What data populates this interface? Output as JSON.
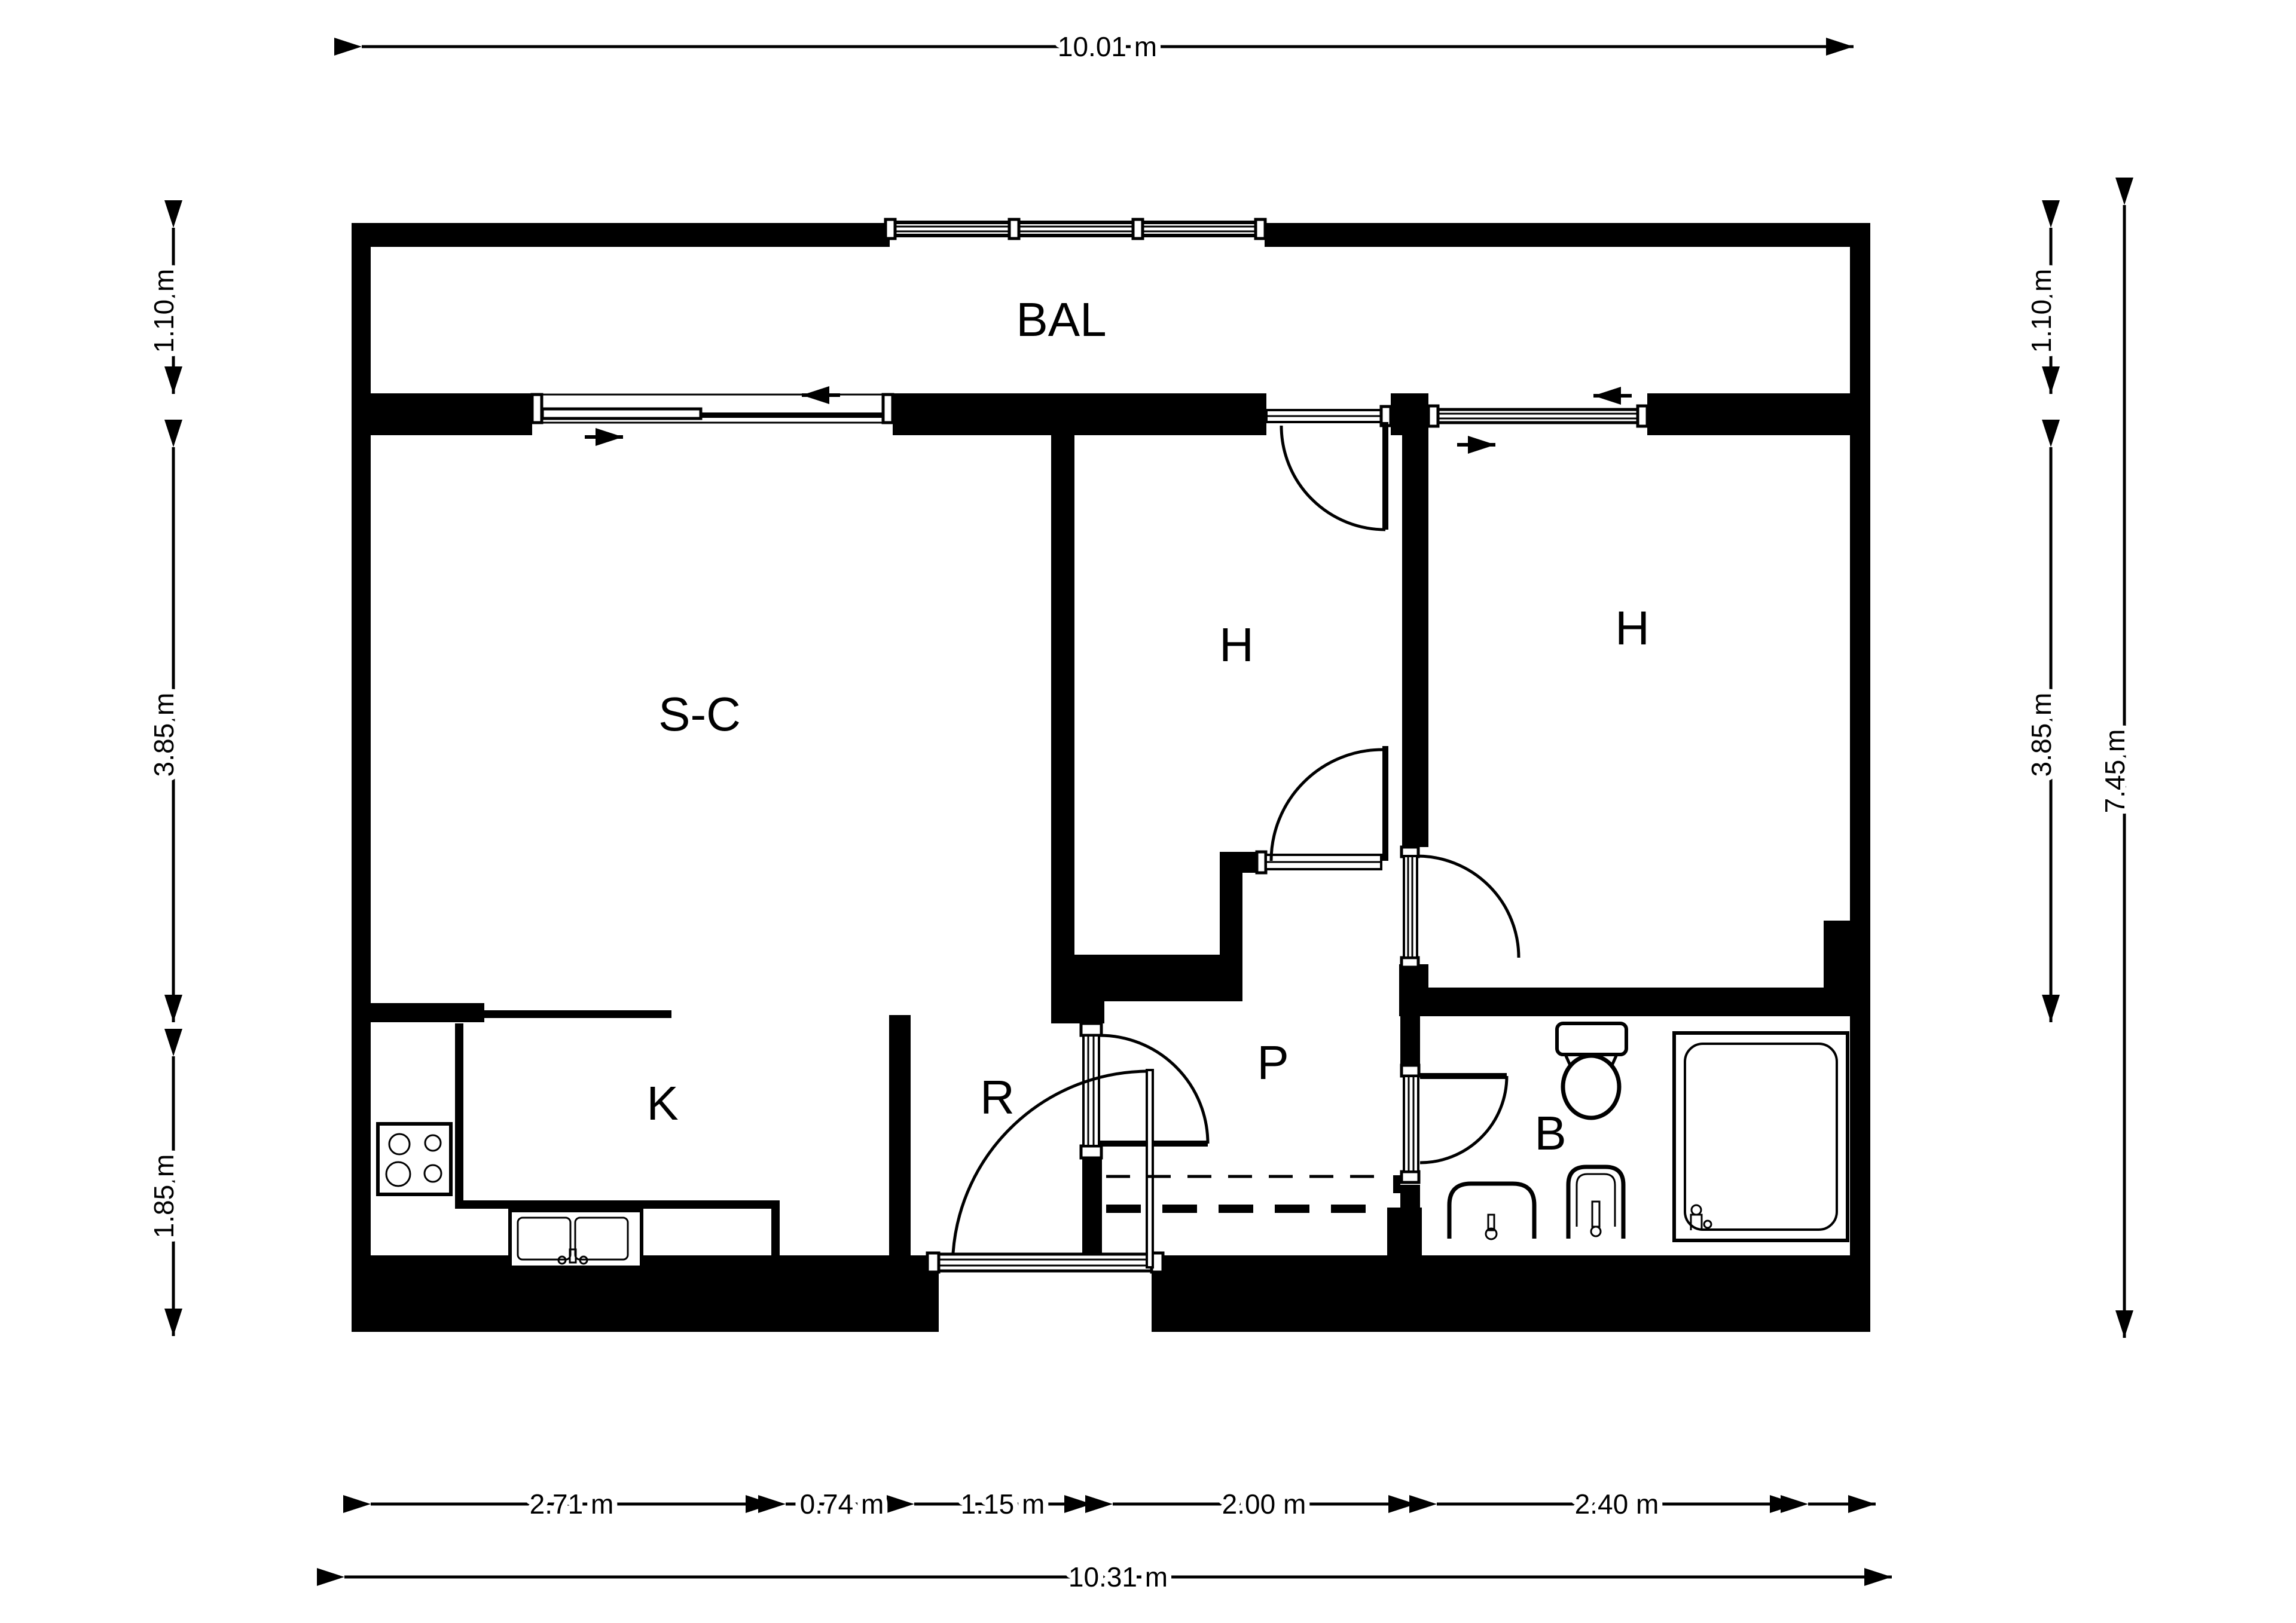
{
  "page": {
    "background": "#ffffff",
    "wall_color": "#000000"
  },
  "rooms": {
    "balcony": "BAL",
    "living": "S-C",
    "bedroom_mid": "H",
    "bedroom_right": "H",
    "kitchen": "K",
    "hall_r": "R",
    "hall_p": "P",
    "bathroom": "B"
  },
  "dimensions": {
    "top_total": "10.01 m",
    "left": [
      "1.10 m",
      "3.85 m",
      "1.85 m"
    ],
    "right": [
      "1.10 m",
      "3.85 m"
    ],
    "right_total": "7.45 m",
    "bottom_segments": [
      "2.71 m",
      "0.74 m",
      "1.15 m",
      "2.00 m",
      "2.40 m"
    ],
    "bottom_total": "10.31 m"
  }
}
